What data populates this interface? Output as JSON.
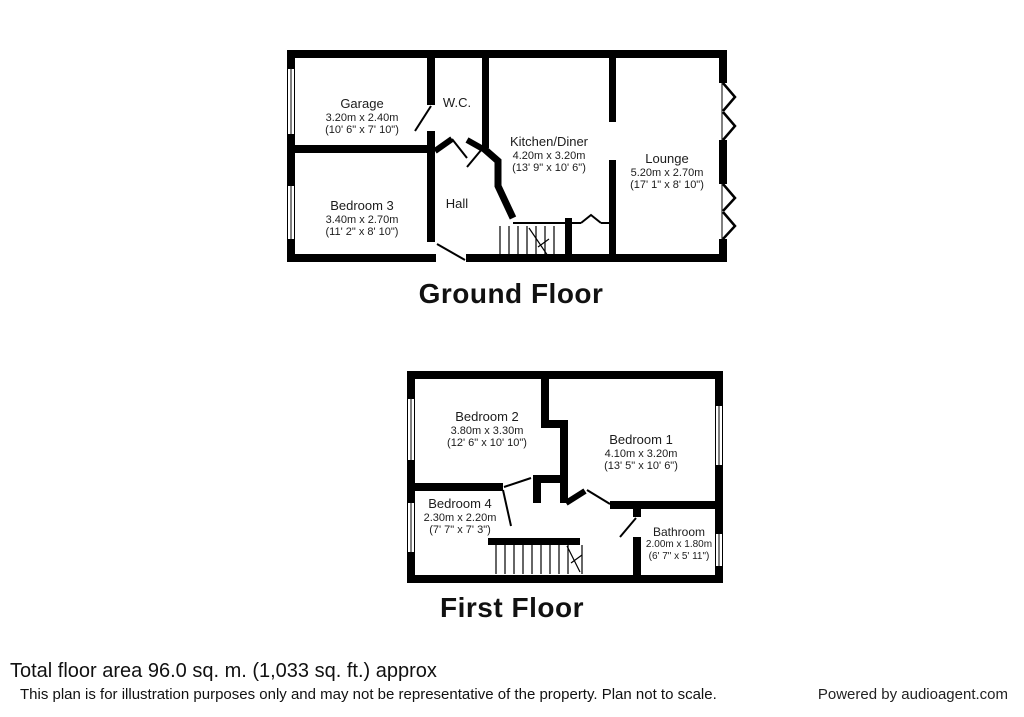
{
  "ground_floor": {
    "title": "Ground Floor",
    "rooms": [
      {
        "name": "Garage",
        "dim_metric": "3.20m x 2.40m",
        "dim_imperial": "(10' 6\" x 7' 10\")"
      },
      {
        "name": "W.C."
      },
      {
        "name": "Kitchen/Diner",
        "dim_metric": "4.20m x 3.20m",
        "dim_imperial": "(13' 9\" x 10' 6\")"
      },
      {
        "name": "Lounge",
        "dim_metric": "5.20m x 2.70m",
        "dim_imperial": "(17' 1\" x 8' 10\")"
      },
      {
        "name": "Bedroom 3",
        "dim_metric": "3.40m x 2.70m",
        "dim_imperial": "(11' 2\" x 8' 10\")"
      },
      {
        "name": "Hall"
      }
    ]
  },
  "first_floor": {
    "title": "First Floor",
    "rooms": [
      {
        "name": "Bedroom 2",
        "dim_metric": "3.80m x 3.30m",
        "dim_imperial": "(12' 6\" x 10' 10\")"
      },
      {
        "name": "Bedroom 1",
        "dim_metric": "4.10m x 3.20m",
        "dim_imperial": "(13' 5\" x 10' 6\")"
      },
      {
        "name": "Bedroom 4",
        "dim_metric": "2.30m x 2.20m",
        "dim_imperial": "(7' 7\" x 7' 3\")"
      },
      {
        "name": "Bathroom",
        "dim_metric": "2.00m x 1.80m",
        "dim_imperial": "(6' 7\" x 5' 11\")"
      }
    ]
  },
  "footer": {
    "total_area": "Total floor area 96.0 sq. m. (1,033 sq. ft.) approx",
    "disclaimer": "This plan is for illustration purposes only and may not be representative of the property. Plan not to scale.",
    "credit": "Powered by audioagent.com"
  },
  "colors": {
    "wall": "#000000",
    "text": "#1a1a1a",
    "background": "#ffffff"
  }
}
